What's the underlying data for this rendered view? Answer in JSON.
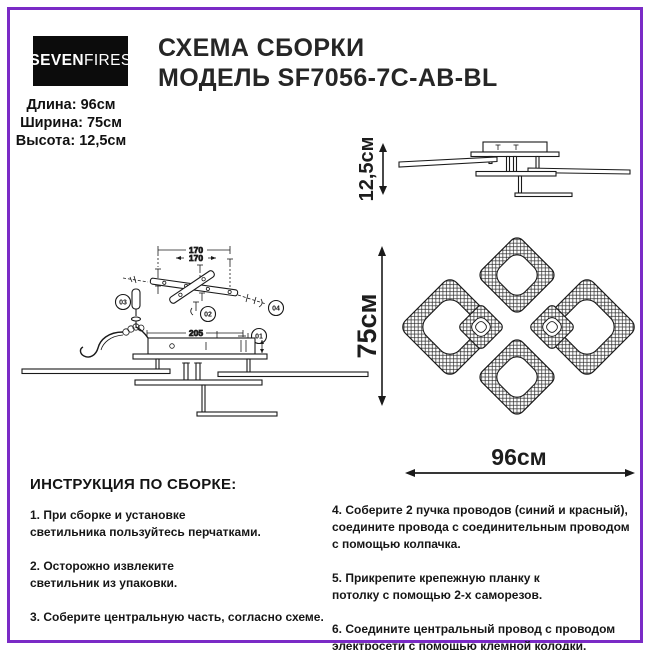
{
  "page": {
    "accent_color": "#7a2ac6",
    "logo_bg": "#0c0c0c"
  },
  "header": {
    "logo_bold": "SEVEN",
    "logo_light": "FIRES",
    "title_line1": "СХЕМА СБОРКИ",
    "title_line2": "МОДЕЛЬ SF7056-7C-AB-BL",
    "dimensions": [
      "Длина: 96см",
      "Ширина: 75см",
      "Высота: 12,5см"
    ]
  },
  "diagrams": {
    "side_view": {
      "height_label": "12,5см"
    },
    "exploded": {
      "dim_wide": "170",
      "dim_narrow": "170",
      "dim_body": "205",
      "width_label": "75см",
      "callouts": [
        "01",
        "02",
        "03",
        "04"
      ]
    },
    "top_view": {
      "width_label": "96см"
    }
  },
  "instructions": {
    "heading": "ИНСТРУКЦИЯ ПО СБОРКЕ:",
    "left": [
      "1. При сборке и установке\nсветильника пользуйтесь перчатками.",
      "2. Осторожно извлеките\nсветильник из упаковки.",
      "3. Соберите центральную часть, согласно схеме."
    ],
    "right": [
      "4. Соберите 2 пучка проводов (синий и красный),\nсоедините провода с соединительным проводом\nс помощью колпачка.",
      "5. Прикрепите крепежную планку к\nпотолку с помощью 2-х саморезов.",
      "6. Соедините центральный провод с проводом\nэлектросети с помощью клемной колодки."
    ]
  }
}
